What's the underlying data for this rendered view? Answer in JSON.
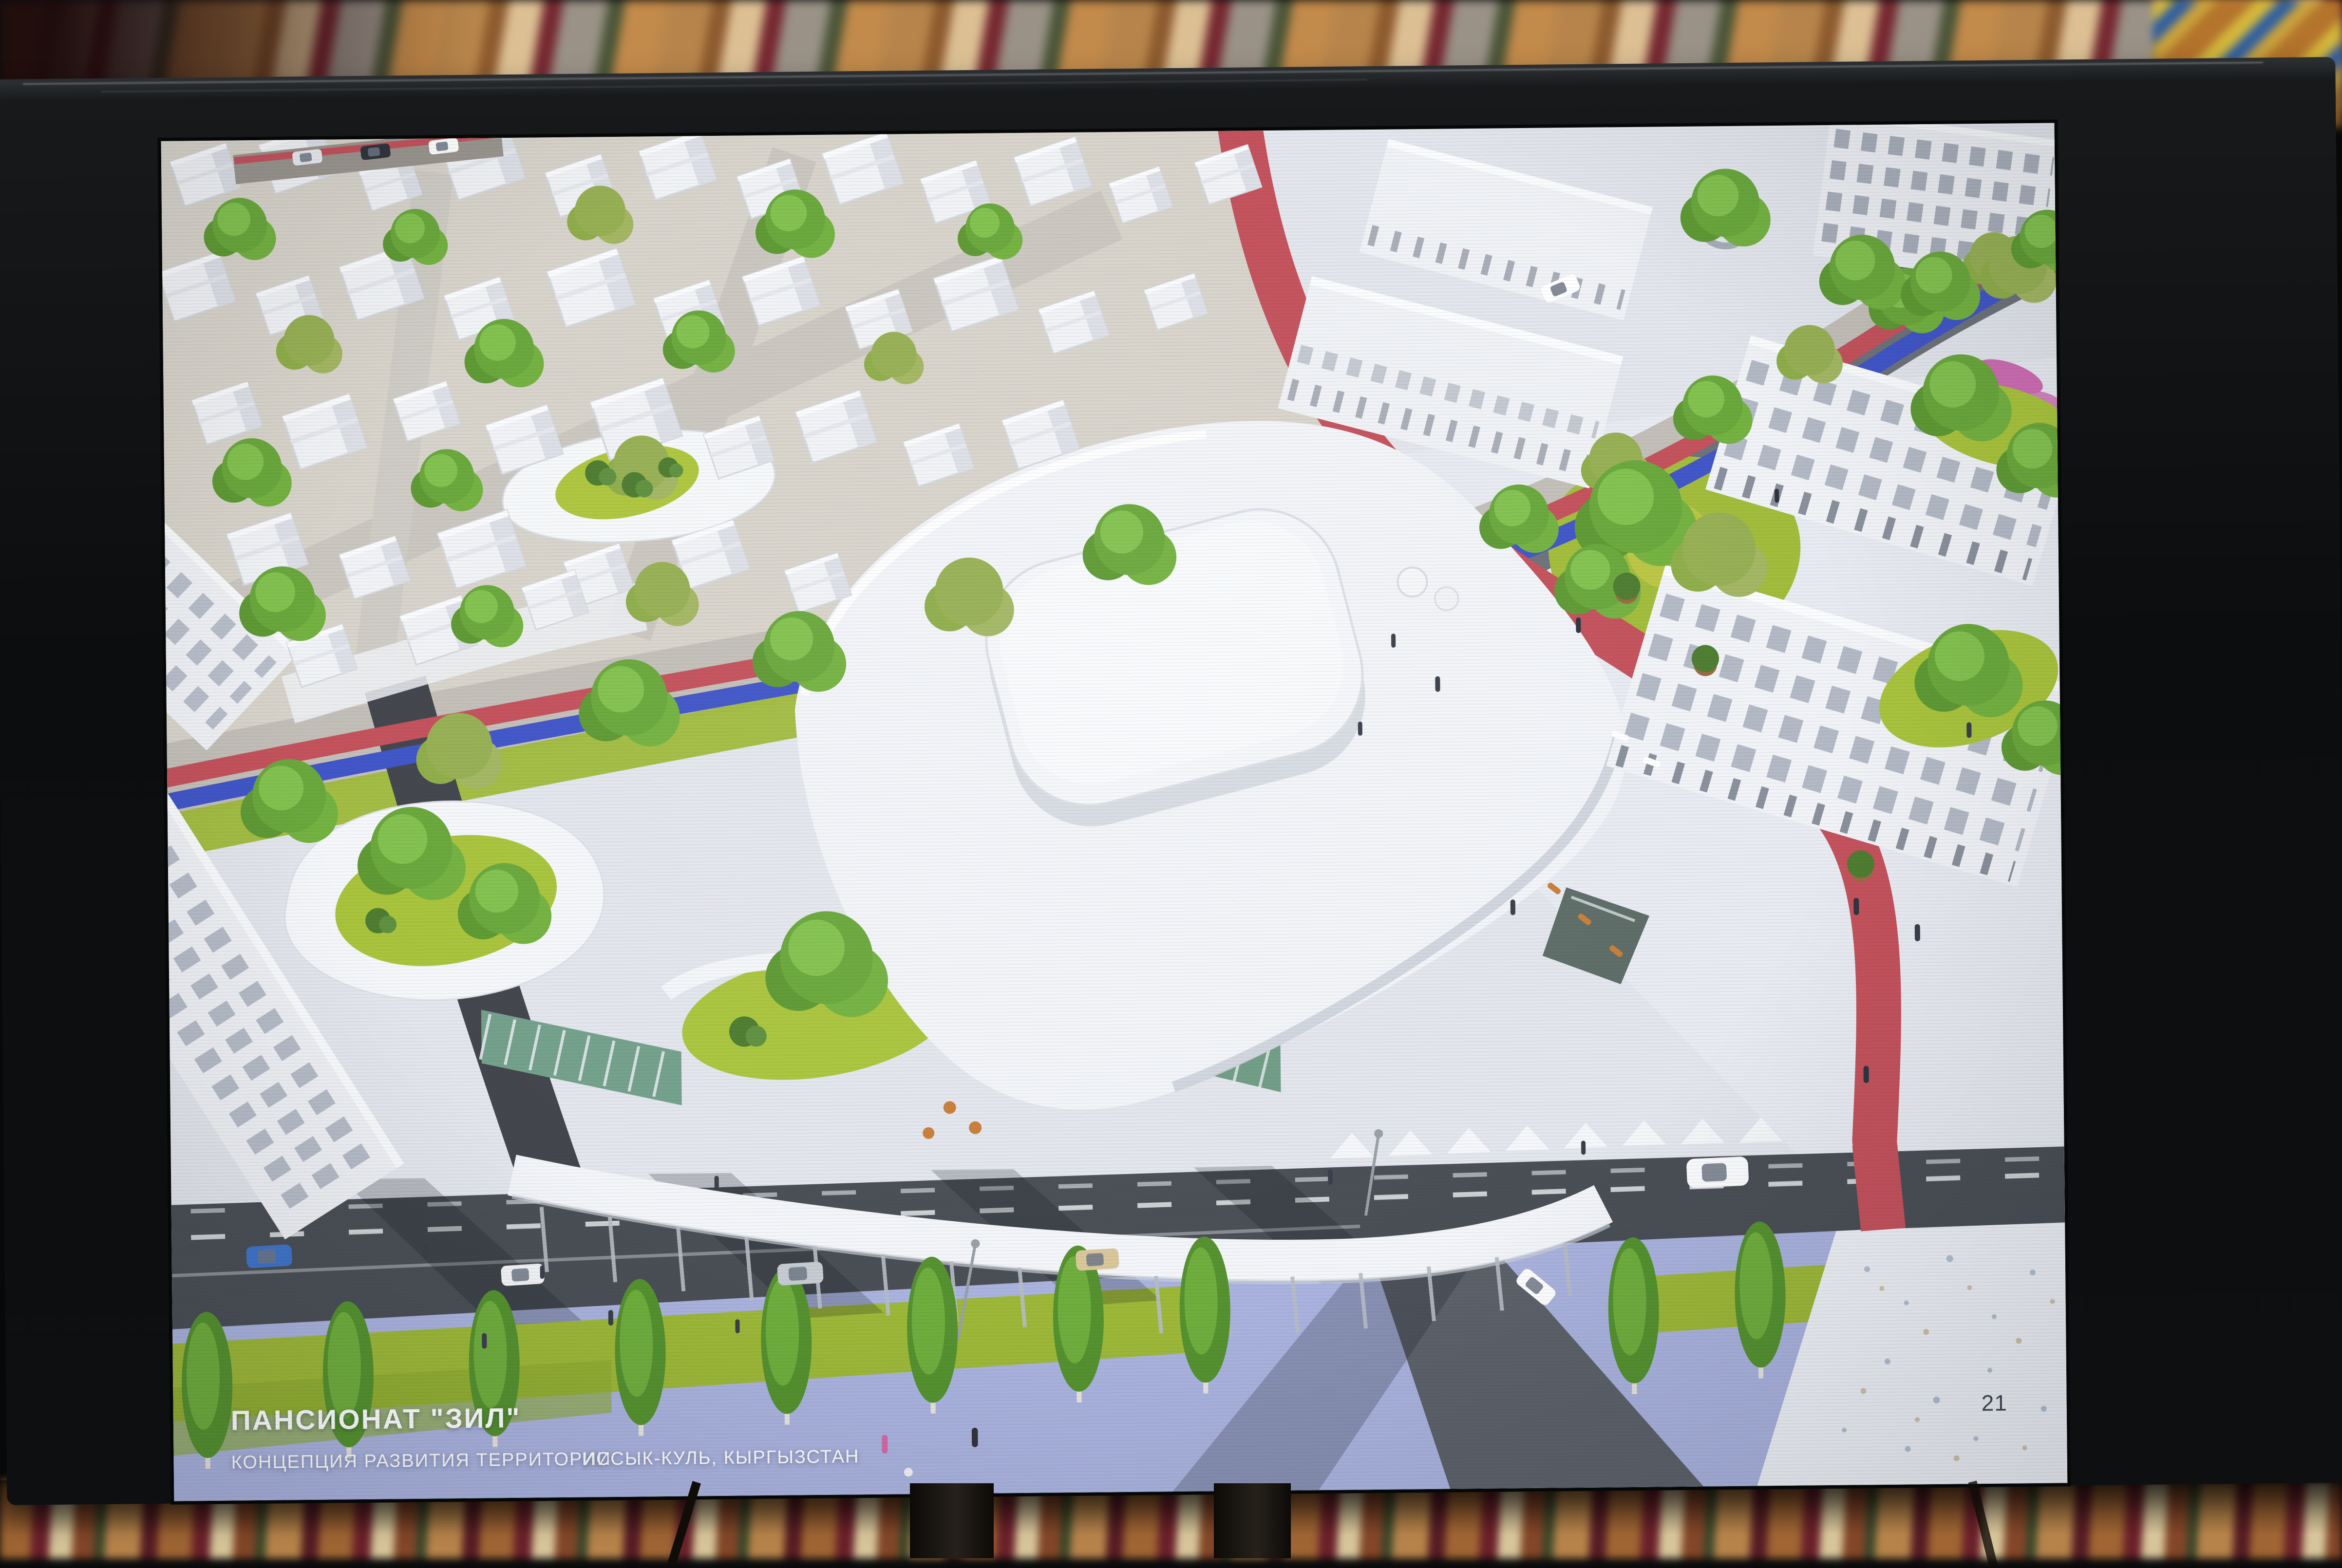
{
  "slide": {
    "title": "ПАНСИОНАТ \"ЗИЛ\"",
    "subtitle": "КОНЦЕПЦИЯ РАЗВИТИЯ ТЕРРИТОРИИ",
    "location": "ИССЫК-КУЛЬ, КЫРГЫЗСТАН",
    "page_number": "21"
  },
  "colors": {
    "bike_path_red": "#c4525c",
    "bike_path_blue": "#4156c8",
    "lawn_green": "#a9c43c",
    "tree_green": "#6aa83c",
    "asphalt_dark": "#4a4e55",
    "pavement_light": "#e3e6ec",
    "promenade_lavender": "#aab3de",
    "building_white": "#f2f4f8",
    "bezel_black": "#0d0f11"
  }
}
